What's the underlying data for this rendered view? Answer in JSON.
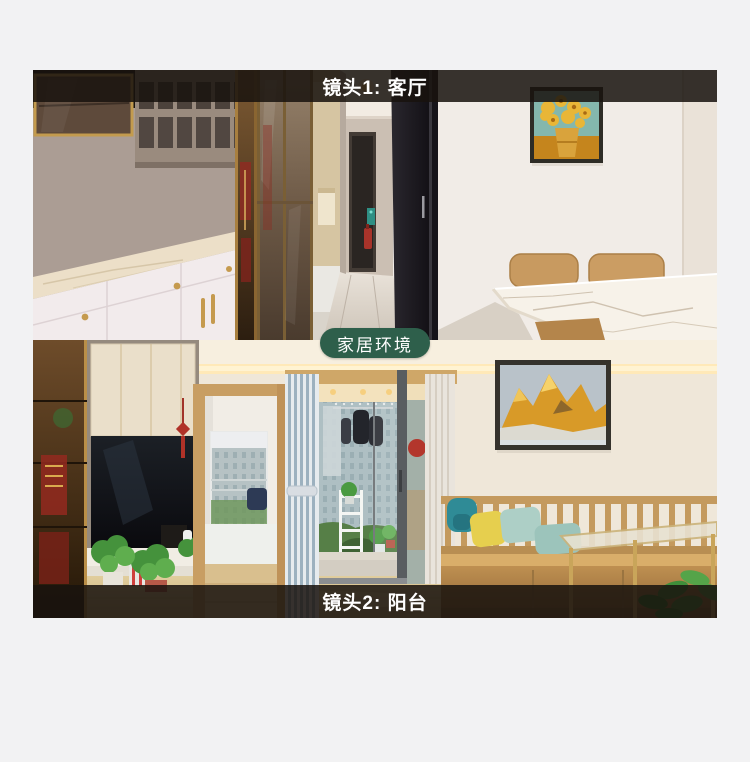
{
  "page": {
    "background_color": "#f2f2f3"
  },
  "gallery": {
    "top_banner": {
      "label": "镜头1: 客厅",
      "background_color": "rgba(24,19,14,0.86)",
      "text_color": "#ffffff"
    },
    "middle_badge": {
      "label": "家居环境",
      "background_color": "#2e5f4b",
      "text_color": "#ffffff"
    },
    "bottom_banner": {
      "label": "镜头2: 阳台",
      "background_color": "rgba(24,19,14,0.86)",
      "text_color": "#ffffff"
    }
  }
}
